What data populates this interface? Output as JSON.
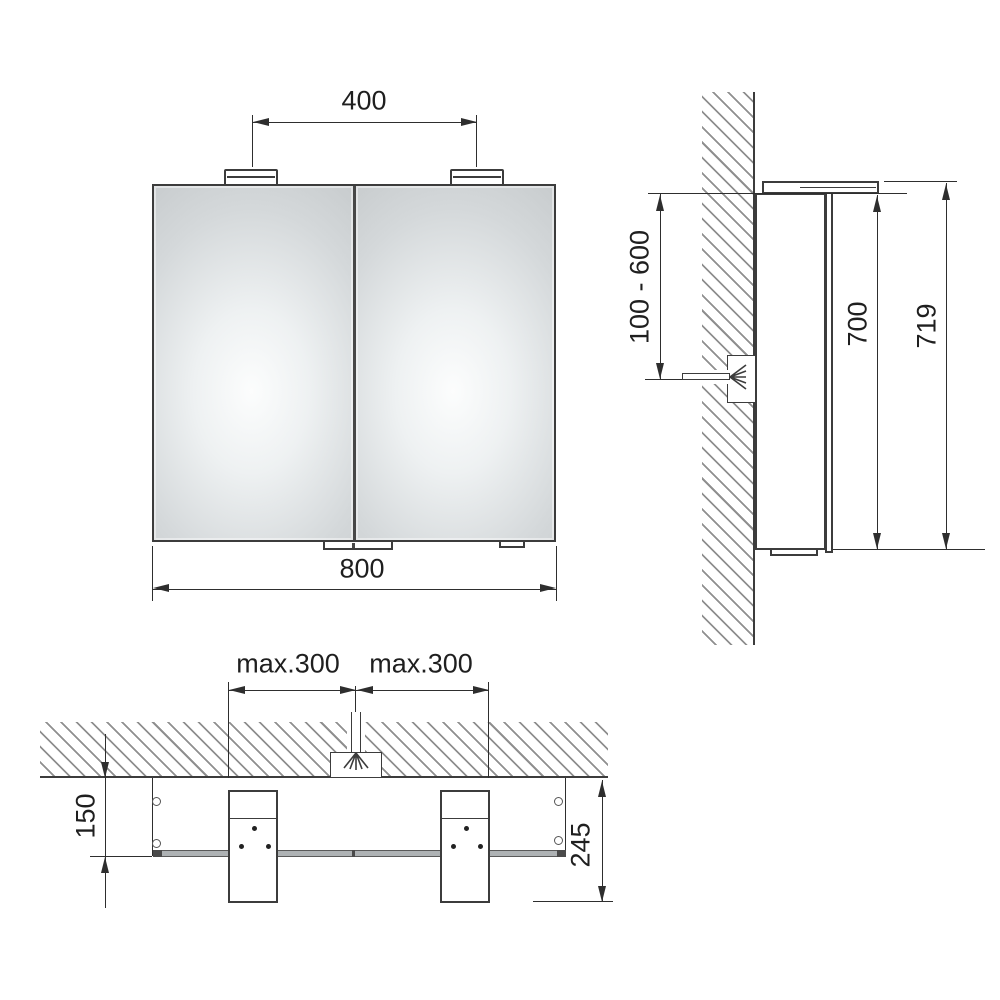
{
  "front_view": {
    "lamp_spacing_mm": "400",
    "cabinet_width_mm": "800"
  },
  "side_view": {
    "outlet_height_range_mm": "100 - 600",
    "cabinet_height_mm": "700",
    "total_height_mm": "719"
  },
  "plan_view": {
    "lamp_offset_left": "max.300",
    "lamp_offset_right": "max.300",
    "wall_to_mirror_front_mm": "150",
    "total_depth_mm": "245"
  },
  "colors": {
    "line": "#2e2e2e",
    "object_border": "#3c3c3c",
    "hatch": "#8f8f8f",
    "mirror_fill": "#cdd1d3",
    "mirror_highlight": "#fbfcfd",
    "mirror_bar": "#aeb2b4",
    "background": "#ffffff"
  }
}
